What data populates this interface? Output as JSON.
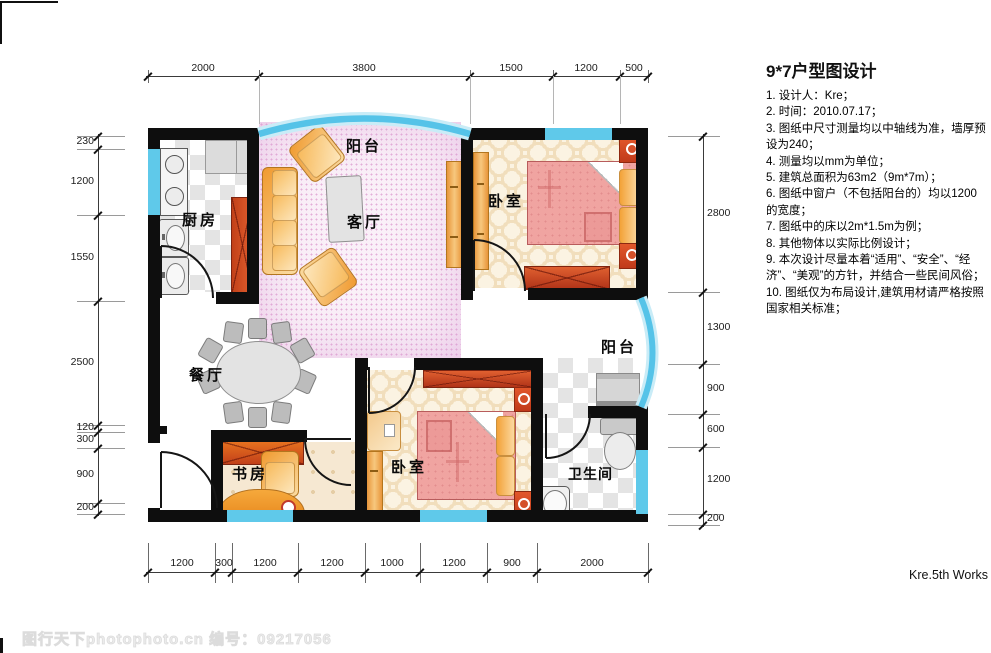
{
  "title": "9*7户型图设计",
  "notes": [
    "1. 设计人：Kre；",
    "2. 时间：2010.07.17；",
    "3. 图纸中尺寸测量均以中轴线为准，墙厚预设为240；",
    "4. 测量均以mm为单位；",
    "5. 建筑总面积为63m2（9m*7m）；",
    "6. 图纸中窗户（不包括阳台的）均以1200的宽度；",
    "7. 图纸中的床以2m*1.5m为例；",
    "8. 其他物体以实际比例设计；",
    "9. 本次设计尽量本着“适用”、“安全”、“经济”、“美观”的方针，并结合一些民间风俗；",
    "10. 图纸仅为布局设计,建筑用材请严格按照国家相关标准；"
  ],
  "labels": {
    "balcony_top": "阳台",
    "kitchen": "厨房",
    "living": "客厅",
    "bedroom_top": "卧室",
    "dining": "餐厅",
    "study": "书房",
    "bedroom_bottom": "卧室",
    "bathroom": "卫生间",
    "balcony_right": "阳台"
  },
  "dims": {
    "top": [
      "2000",
      "3800",
      "1500",
      "1200",
      "500"
    ],
    "left": [
      "230",
      "1200",
      "1550",
      "2500",
      "120",
      "300",
      "900",
      "200"
    ],
    "right": [
      "2800",
      "1300",
      "900",
      "600",
      "1200",
      "200"
    ],
    "bottom": [
      "1200",
      "300",
      "1200",
      "1200",
      "1000",
      "1200",
      "900",
      "2000"
    ]
  },
  "signature": "Kre.5th Works",
  "watermark": "图行天下photophoto.cn  编号：09217056",
  "colors": {
    "wall": "#0e0e0e",
    "window": "#5fc9ea",
    "bed_pink": "#f0a4a1",
    "cabinet_red": "#c03a1a",
    "furniture_orange": "#f09a30",
    "floor_cream": "#fbf3e2",
    "floor_living": "#faf0f8"
  }
}
